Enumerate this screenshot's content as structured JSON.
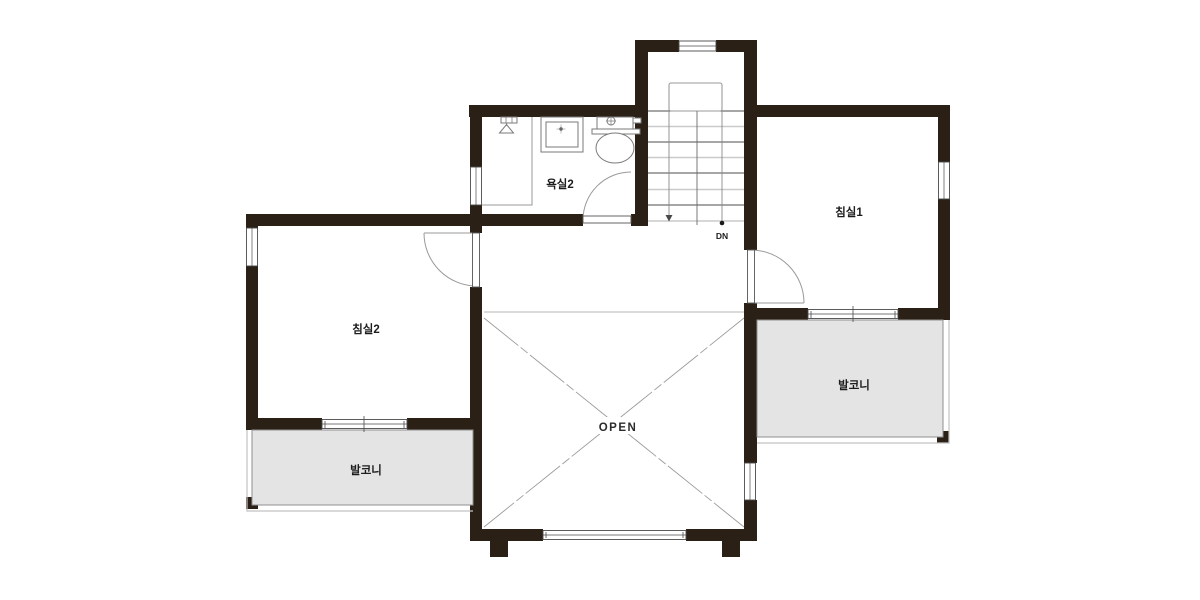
{
  "labels": {
    "bathroom2": "욕실2",
    "bedroom1": "침실1",
    "bedroom2": "침실2",
    "balcony_left": "발코니",
    "balcony_right": "발코니",
    "open_area": "OPEN",
    "stairs_down": "DN"
  },
  "colors": {
    "background": "#ffffff",
    "wall": "#2b2015",
    "balcony_fill": "#e4e4e5",
    "balcony_border": "#8f8f8f",
    "outer_line": "#c2c2c2",
    "thin_line": "#9b9b9b",
    "label_text": "#1c1c1c"
  }
}
